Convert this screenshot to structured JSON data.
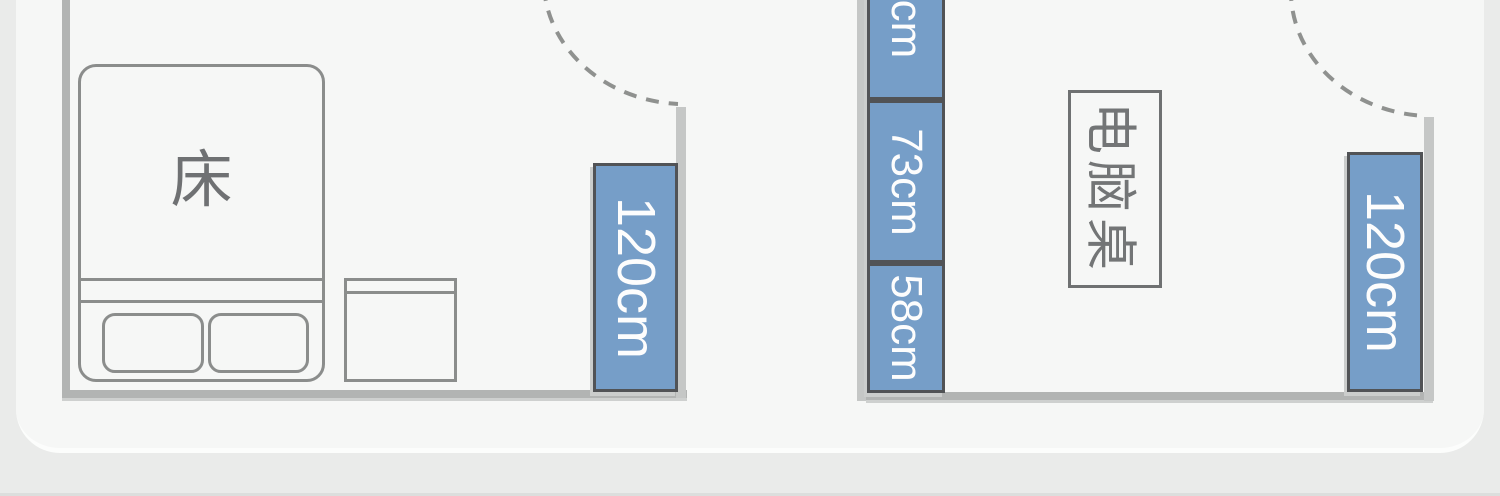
{
  "diagram": {
    "type": "floor-plan",
    "bedroom": {
      "bed_label": "床",
      "clearance_label": "120cm"
    },
    "study": {
      "desk_label": "电脑桌",
      "clearance_label": "120cm"
    },
    "middle_dimensions": {
      "top_partial_label": "cm",
      "middle_label": "73cm",
      "bottom_label": "58cm"
    },
    "colors": {
      "dimension_blue": "#769ec8",
      "dimension_box_border": "#515356",
      "dimension_text": "#fdfdfd",
      "wall_gray": "#b2b4b3",
      "wall_light_gray": "#c5c7c6",
      "furniture_outline": "#8b8d8c",
      "label_gray": "#6f7173",
      "panel_white": "#f6f7f6",
      "background_gray": "#eaebea"
    }
  }
}
